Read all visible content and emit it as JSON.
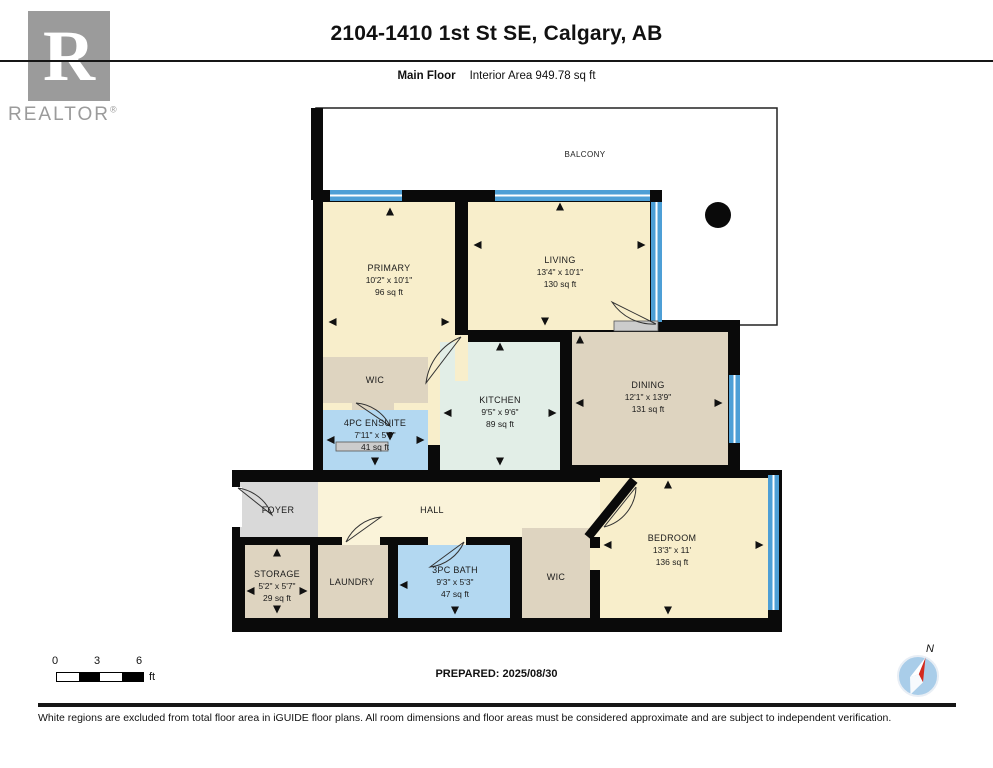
{
  "header": {
    "logo": {
      "letter": "R",
      "brand": "REALTOR",
      "reg": "®"
    },
    "title": "2104-1410 1st St SE, Calgary, AB",
    "floor_label": "Main Floor",
    "area_label": "Interior Area 949.78 sq ft"
  },
  "rooms": {
    "balcony": {
      "name": "BALCONY"
    },
    "primary": {
      "name": "PRIMARY",
      "dims": "10'2\" x 10'1\"",
      "area": "96 sq ft"
    },
    "living": {
      "name": "LIVING",
      "dims": "13'4\" x 10'1\"",
      "area": "130 sq ft"
    },
    "wic_top": {
      "name": "WIC"
    },
    "ensuite": {
      "name": "4PC ENSUITE",
      "dims": "7'11\" x 5'5\"",
      "area": "41 sq ft"
    },
    "kitchen": {
      "name": "KITCHEN",
      "dims": "9'5\" x 9'6\"",
      "area": "89 sq ft"
    },
    "dining": {
      "name": "DINING",
      "dims": "12'1\" x 13'9\"",
      "area": "131 sq ft"
    },
    "foyer": {
      "name": "FOYER"
    },
    "hall": {
      "name": "HALL"
    },
    "storage": {
      "name": "STORAGE",
      "dims": "5'2\" x 5'7\"",
      "area": "29 sq ft"
    },
    "laundry": {
      "name": "LAUNDRY"
    },
    "bath": {
      "name": "3PC BATH",
      "dims": "9'3\" x 5'3\"",
      "area": "47 sq ft"
    },
    "wic_bottom": {
      "name": "WIC"
    },
    "bedroom": {
      "name": "BEDROOM",
      "dims": "13'3\" x 11'",
      "area": "136 sq ft"
    }
  },
  "footer": {
    "scale": {
      "ticks": [
        "0",
        "3",
        "6"
      ],
      "unit": "ft"
    },
    "prepared": "PREPARED: 2025/08/30",
    "compass_label": "N",
    "disclaimer": "White regions are excluded from total floor area in iGUIDE floor plans. All room dimensions and floor areas must be considered approximate and are subject to independent verification."
  },
  "colors": {
    "room_cream": "#f8eecb",
    "room_tan": "#ded4c0",
    "room_blue": "#b3d8f1",
    "room_kitchen": "#e2eee7",
    "room_grey": "#d9d9d9",
    "window_blue": "#4d9fd6",
    "wall_black": "#0a0a0a",
    "logo_grey": "#9b9b9b",
    "compass_red": "#d42a1e",
    "compass_fill": "#a9cde9"
  }
}
